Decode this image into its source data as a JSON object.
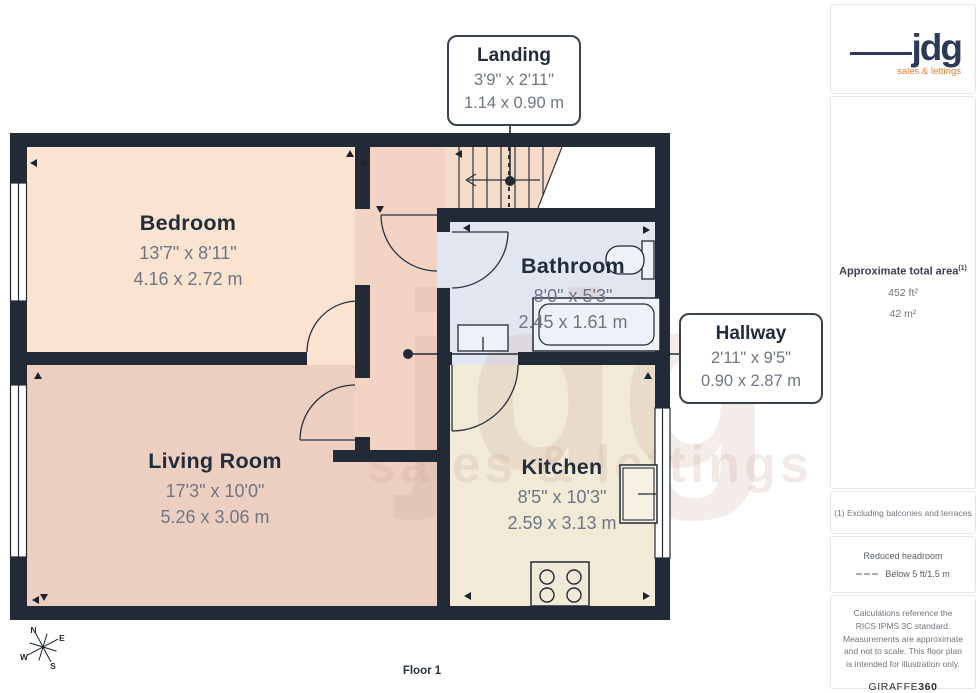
{
  "plan": {
    "floor_label": "Floor 1",
    "watermark": {
      "text": "jdg",
      "subtext": "sales & lettings"
    },
    "compass": {
      "n": "N",
      "e": "E",
      "s": "S",
      "w": "W"
    },
    "rooms": {
      "bedroom": {
        "name": "Bedroom",
        "imperial": "13'7\" x 8'11\"",
        "metric": "4.16 x 2.72 m"
      },
      "living": {
        "name": "Living Room",
        "imperial": "17'3\" x 10'0\"",
        "metric": "5.26 x 3.06 m"
      },
      "kitchen": {
        "name": "Kitchen",
        "imperial": "8'5\" x 10'3\"",
        "metric": "2.59 x 3.13 m"
      },
      "bathroom": {
        "name": "Bathroom",
        "imperial": "8'0\" x 5'3\"",
        "metric": "2.45 x 1.61 m"
      }
    },
    "callouts": {
      "landing": {
        "name": "Landing",
        "imperial": "3'9\" x 2'11\"",
        "metric": "1.14 x 0.90 m"
      },
      "hallway": {
        "name": "Hallway",
        "imperial": "2'11\" x 9'5\"",
        "metric": "0.90 x 2.87 m"
      }
    }
  },
  "sidebar": {
    "logo": {
      "text": "jdg",
      "tagline": "sales & lettings"
    },
    "area": {
      "title": "Approximate total area",
      "superscript": "(1)",
      "imperial": "452 ft²",
      "metric": "42 m²"
    },
    "footnote": "(1) Excluding balconies and terraces",
    "headroom": {
      "title": "Reduced headroom",
      "legend": "Below 5 ft/1.5 m"
    },
    "disclaimer": "Calculations reference the RICS IPMS 3C standard. Measurements are approximate and not to scale. This floor plan is intended for illustration only.",
    "brand": {
      "name": "GIRAFFE",
      "suffix": "360"
    }
  },
  "colors": {
    "wall": "#222a38",
    "bedroom_floor": "#fae3d0",
    "living_floor": "#eccfc1",
    "kitchen_floor": "#f1ead7",
    "bathroom_floor": "#e2e6f1",
    "hallway_floor": "#f3d3c4",
    "logo_navy": "#2c3a58",
    "logo_orange": "#e8792e"
  }
}
